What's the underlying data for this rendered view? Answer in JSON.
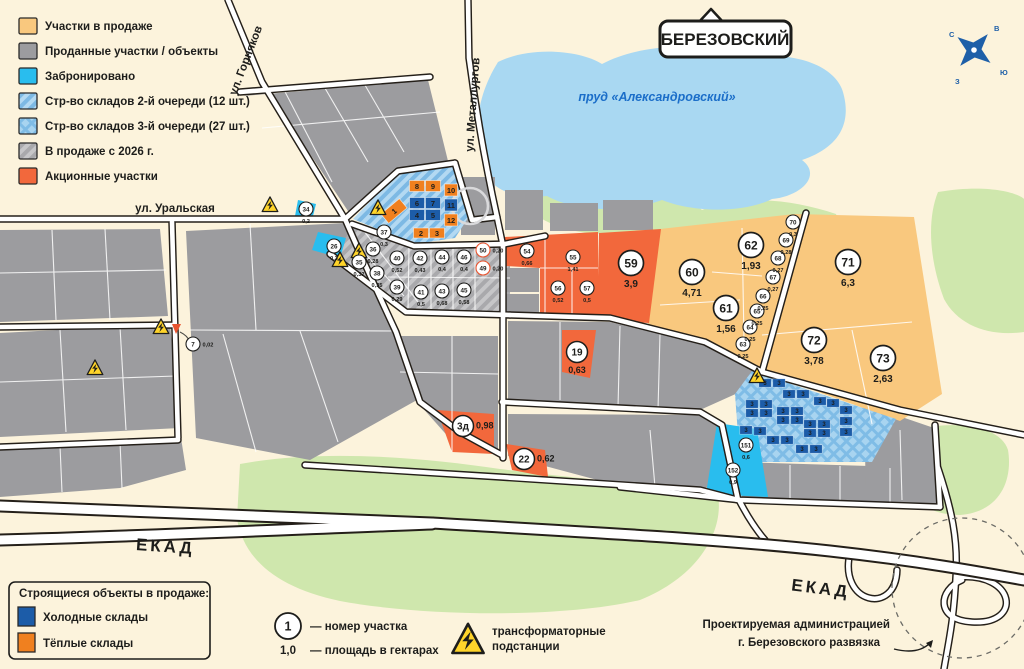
{
  "city_sign": "БЕРЕЗОВСКИЙ",
  "pond_label": "пруд «Александровский»",
  "compass": {
    "n": "С",
    "e": "В",
    "w": "З",
    "s": "Ю"
  },
  "streets": {
    "gornyakov": "ул. Горняков",
    "metallurgov": "ул. Металлургов",
    "uralskaya": "ул. Уральская",
    "ekad_left": "ЕКАД",
    "ekad_right": "ЕКАД"
  },
  "legend": {
    "items": [
      {
        "label": "Участки в продаже",
        "fill": "#f9c87e"
      },
      {
        "label": "Проданные участки / объекты",
        "fill": "#9c9c9f"
      },
      {
        "label": "Забронировано",
        "fill": "#29bdee"
      },
      {
        "label": "Стр-во складов 2-й очереди (12 шт.)",
        "fill": "diagBlue"
      },
      {
        "label": "Стр-во складов 3-й очереди (27 шт.)",
        "fill": "crossBlue"
      },
      {
        "label": "В продаже с 2026 г.",
        "fill": "diagGray"
      },
      {
        "label": "Акционные участки",
        "fill": "#f2683c"
      }
    ]
  },
  "construction_legend": {
    "title": "Строящиеся объекты в продаже:",
    "items": [
      {
        "label": "Холодные склады",
        "fill": "#1c5ca8"
      },
      {
        "label": "Тёплые склады",
        "fill": "#f0801f"
      }
    ]
  },
  "key_legend": {
    "number_example": "1",
    "area_example": "1,0",
    "number_label": "— номер участка",
    "area_label": "— площадь в гектарах",
    "transformer_label_1": "трансформаторные",
    "transformer_label_2": "подстанции"
  },
  "annotation": {
    "line1": "Проектируемая администрацией",
    "line2": "г. Березовского развязка"
  },
  "plots": [
    {
      "n": "7",
      "a": "0,02",
      "x": 193,
      "y": 344,
      "s": "s",
      "vp": "r"
    },
    {
      "n": "26",
      "a": "0,3",
      "x": 334,
      "y": 246,
      "s": "s"
    },
    {
      "n": "34",
      "a": "0,2",
      "x": 306,
      "y": 209,
      "s": "s"
    },
    {
      "n": "35",
      "a": "0,32",
      "x": 359,
      "y": 262,
      "s": "s"
    },
    {
      "n": "36",
      "a": "0,28",
      "x": 373,
      "y": 249,
      "s": "s"
    },
    {
      "n": "37",
      "a": "0,3",
      "x": 384,
      "y": 232,
      "s": "s"
    },
    {
      "n": "38",
      "a": "0,35",
      "x": 377,
      "y": 273,
      "s": "s"
    },
    {
      "n": "39",
      "a": "0,29",
      "x": 397,
      "y": 287,
      "s": "s"
    },
    {
      "n": "40",
      "a": "0,52",
      "x": 397,
      "y": 258,
      "s": "s"
    },
    {
      "n": "41",
      "a": "0,5",
      "x": 421,
      "y": 292,
      "s": "s"
    },
    {
      "n": "42",
      "a": "0,43",
      "x": 420,
      "y": 258,
      "s": "s"
    },
    {
      "n": "43",
      "a": "0,68",
      "x": 442,
      "y": 291,
      "s": "s"
    },
    {
      "n": "44",
      "a": "0,4",
      "x": 442,
      "y": 257,
      "s": "s"
    },
    {
      "n": "45",
      "a": "0,58",
      "x": 464,
      "y": 290,
      "s": "s"
    },
    {
      "n": "46",
      "a": "0,4",
      "x": 464,
      "y": 257,
      "s": "s"
    },
    {
      "n": "49",
      "a": "0,20",
      "x": 483,
      "y": 268,
      "s": "s",
      "vp": "r",
      "oc": true
    },
    {
      "n": "50",
      "a": "0,20",
      "x": 483,
      "y": 250,
      "s": "s",
      "vp": "r",
      "oc": true
    },
    {
      "n": "54",
      "a": "0,66",
      "x": 527,
      "y": 251,
      "s": "s"
    },
    {
      "n": "55",
      "a": "1,41",
      "x": 573,
      "y": 257,
      "s": "s"
    },
    {
      "n": "56",
      "a": "0,52",
      "x": 558,
      "y": 288,
      "s": "s"
    },
    {
      "n": "57",
      "a": "0,5",
      "x": 587,
      "y": 288,
      "s": "s"
    },
    {
      "n": "19",
      "a": "0,63",
      "x": 577,
      "y": 352,
      "s": "m"
    },
    {
      "n": "3д",
      "a": "0,98",
      "x": 463,
      "y": 426,
      "s": "m",
      "vp": "r"
    },
    {
      "n": "22",
      "a": "0,62",
      "x": 524,
      "y": 459,
      "s": "m",
      "vp": "r"
    },
    {
      "n": "59",
      "a": "3,9",
      "x": 631,
      "y": 263,
      "s": "b"
    },
    {
      "n": "60",
      "a": "4,71",
      "x": 692,
      "y": 272,
      "s": "b"
    },
    {
      "n": "61",
      "a": "1,56",
      "x": 726,
      "y": 308,
      "s": "b"
    },
    {
      "n": "62",
      "a": "1,93",
      "x": 751,
      "y": 245,
      "s": "b"
    },
    {
      "n": "71",
      "a": "6,3",
      "x": 848,
      "y": 262,
      "s": "b"
    },
    {
      "n": "72",
      "a": "3,78",
      "x": 814,
      "y": 340,
      "s": "b"
    },
    {
      "n": "73",
      "a": "2,63",
      "x": 883,
      "y": 358,
      "s": "b"
    },
    {
      "n": "63",
      "a": "0,25",
      "x": 743,
      "y": 344,
      "s": "s"
    },
    {
      "n": "64",
      "a": "0,25",
      "x": 750,
      "y": 327,
      "s": "s"
    },
    {
      "n": "65",
      "a": "0,25",
      "x": 757,
      "y": 311,
      "s": "s"
    },
    {
      "n": "66",
      "a": "0,25",
      "x": 763,
      "y": 296,
      "s": "s"
    },
    {
      "n": "67",
      "a": "0,27",
      "x": 773,
      "y": 277,
      "s": "s"
    },
    {
      "n": "68",
      "a": "0,27",
      "x": 778,
      "y": 258,
      "s": "s"
    },
    {
      "n": "69",
      "a": "0,28",
      "x": 786,
      "y": 240,
      "s": "s"
    },
    {
      "n": "70",
      "a": "0,3",
      "x": 793,
      "y": 222,
      "s": "s"
    },
    {
      "n": "151",
      "a": "0,6",
      "x": 746,
      "y": 445,
      "s": "s"
    },
    {
      "n": "152",
      "a": "0,9",
      "x": 733,
      "y": 470,
      "s": "s"
    }
  ],
  "warehouses": [
    {
      "n": "1",
      "t": "w",
      "x": 394,
      "y": 211,
      "w": 24,
      "h": 12,
      "r": -40
    },
    {
      "n": "8",
      "t": "w",
      "x": 417,
      "y": 186,
      "w": 15,
      "h": 11,
      "r": 0
    },
    {
      "n": "9",
      "t": "w",
      "x": 433,
      "y": 186,
      "w": 15,
      "h": 11,
      "r": 0
    },
    {
      "n": "10",
      "t": "w",
      "x": 451,
      "y": 190,
      "w": 13,
      "h": 12,
      "r": 0
    },
    {
      "n": "6",
      "t": "c",
      "x": 417,
      "y": 203,
      "w": 15,
      "h": 11,
      "r": 0
    },
    {
      "n": "7",
      "t": "c",
      "x": 433,
      "y": 203,
      "w": 15,
      "h": 11,
      "r": 0
    },
    {
      "n": "11",
      "t": "c",
      "x": 451,
      "y": 205,
      "w": 13,
      "h": 12,
      "r": 0
    },
    {
      "n": "4",
      "t": "c",
      "x": 417,
      "y": 215,
      "w": 15,
      "h": 11,
      "r": 0
    },
    {
      "n": "5",
      "t": "c",
      "x": 433,
      "y": 215,
      "w": 15,
      "h": 11,
      "r": 0
    },
    {
      "n": "12",
      "t": "w",
      "x": 451,
      "y": 220,
      "w": 13,
      "h": 12,
      "r": 0
    },
    {
      "n": "2",
      "t": "w",
      "x": 421,
      "y": 233,
      "w": 15,
      "h": 10,
      "r": 0
    },
    {
      "n": "3",
      "t": "w",
      "x": 437,
      "y": 233,
      "w": 15,
      "h": 10,
      "r": 0
    }
  ],
  "stage3_blocks": {
    "label": "3",
    "positions": [
      [
        765,
        383
      ],
      [
        779,
        383
      ],
      [
        789,
        394
      ],
      [
        803,
        394
      ],
      [
        820,
        401
      ],
      [
        833,
        403
      ],
      [
        752,
        404
      ],
      [
        766,
        404
      ],
      [
        752,
        413
      ],
      [
        766,
        413
      ],
      [
        783,
        411
      ],
      [
        797,
        411
      ],
      [
        783,
        420
      ],
      [
        797,
        420
      ],
      [
        810,
        424
      ],
      [
        824,
        424
      ],
      [
        810,
        433
      ],
      [
        824,
        433
      ],
      [
        746,
        430
      ],
      [
        760,
        431
      ],
      [
        773,
        440
      ],
      [
        787,
        440
      ],
      [
        802,
        449
      ],
      [
        816,
        449
      ],
      [
        846,
        410
      ],
      [
        846,
        421
      ],
      [
        846,
        432
      ]
    ]
  },
  "transformers": [
    [
      270,
      205
    ],
    [
      378,
      208
    ],
    [
      359,
      251
    ],
    [
      340,
      260
    ],
    [
      161,
      327
    ],
    [
      95,
      368
    ],
    [
      757,
      376
    ]
  ]
}
